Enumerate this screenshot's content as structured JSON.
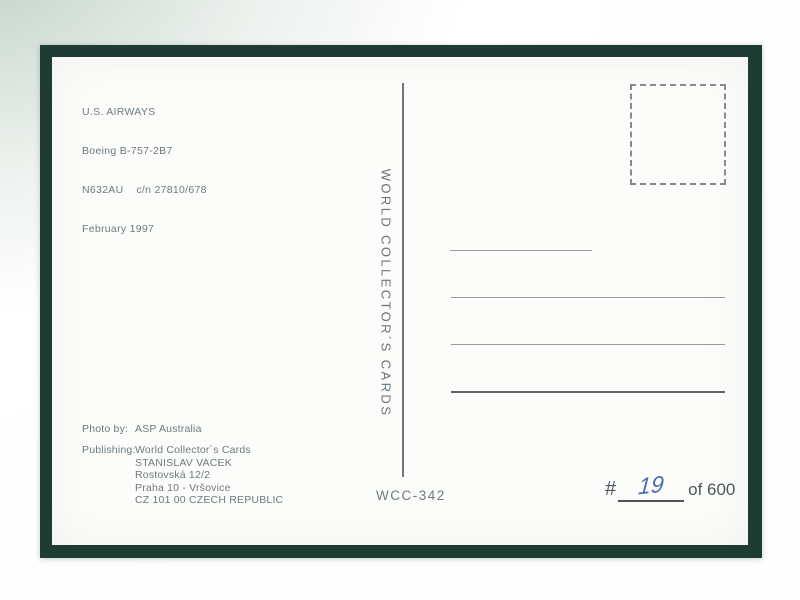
{
  "postcard": {
    "info_lines": [
      "U.S. AIRWAYS",
      "Boeing B-757-2B7",
      "N632AU    c/n 27810/678",
      "February 1997"
    ],
    "brand_vertical_text": "WORLD COLLECTOR´S CARDS",
    "photo_credit": {
      "label": "Photo by:",
      "value": "ASP Australia"
    },
    "publishing": {
      "label": "Publishing:",
      "lines": [
        "World Collector´s Cards",
        "STANISLAV VACEK",
        "Rostovská 12/2",
        "Praha 10 - Vršovice",
        "CZ 101 00 CZECH REPUBLIC"
      ]
    },
    "card_number": "WCC-342",
    "numbering": {
      "hash": "#",
      "handwritten": "19",
      "of_total": "of 600"
    },
    "colors": {
      "frame": "#1e3c34",
      "card": "#fcfcfa",
      "printed_text": "#6d7a82",
      "handwriting_ink": "#4b6cb3",
      "address_line": "#969da1",
      "background_tint": "#bccbc4"
    }
  }
}
